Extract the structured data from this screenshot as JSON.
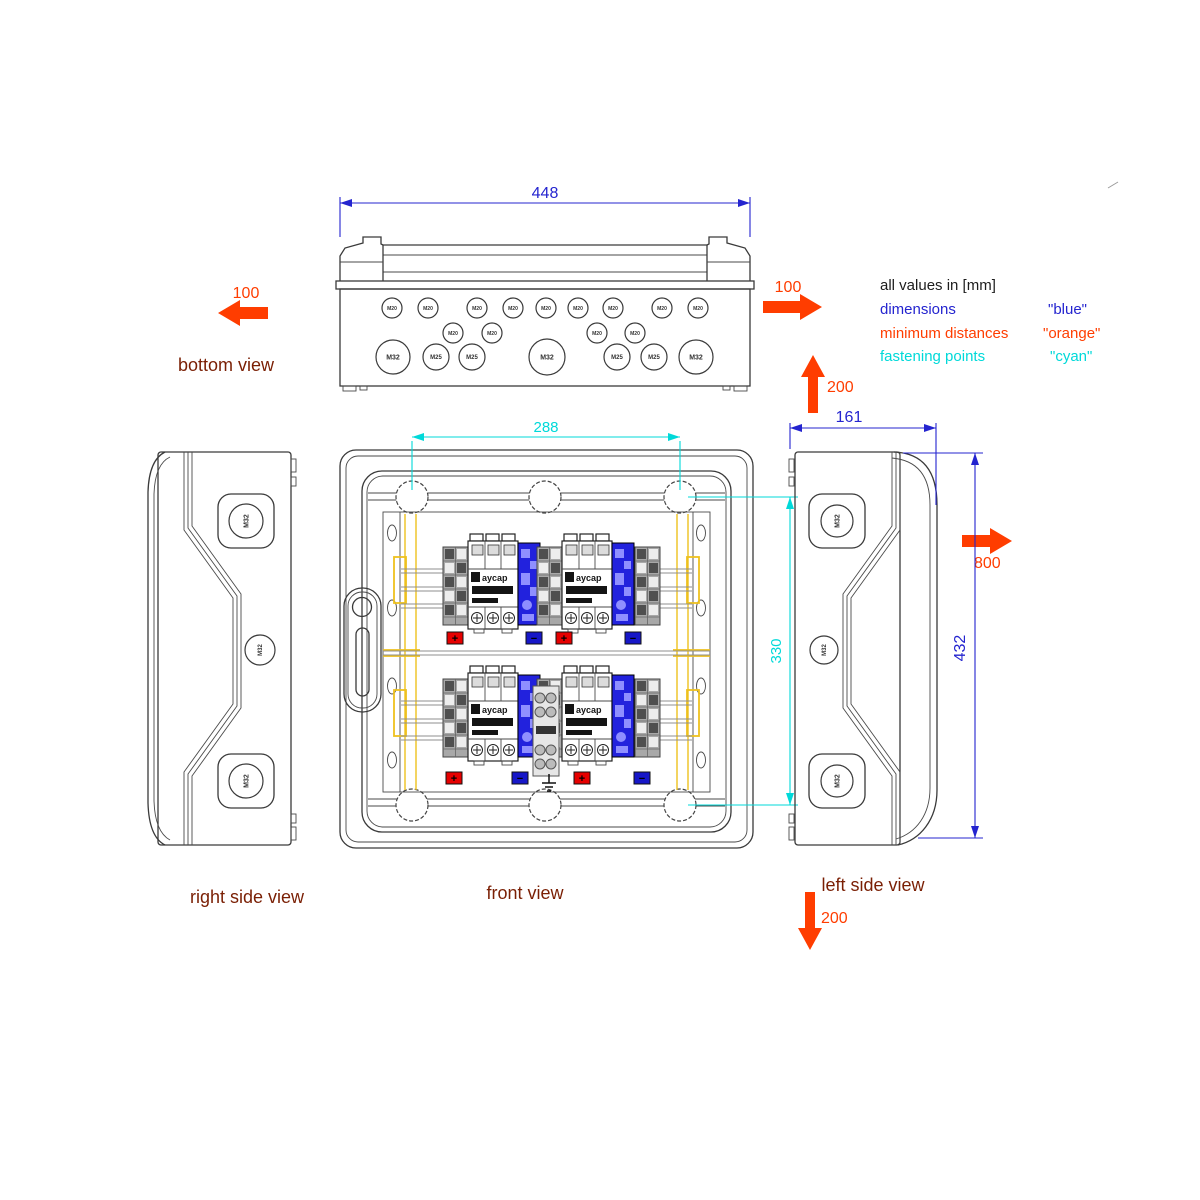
{
  "legend": {
    "title": "all values in [mm]",
    "rows": [
      {
        "label": "dimensions",
        "value": "\"blue\"",
        "color": "#2424cf"
      },
      {
        "label": "minimum distances",
        "value": "\"orange\"",
        "color": "#ff3d00"
      },
      {
        "label": "fastening points",
        "value": "\"cyan\"",
        "color": "#00d9d9"
      }
    ]
  },
  "view_labels": {
    "bottom": "bottom view",
    "front": "front view",
    "right_side": "right side view",
    "left_side": "left side view"
  },
  "dimensions": {
    "overall_width": "448",
    "fastening_width": "288",
    "fastening_height": "330",
    "depth": "161",
    "overall_height": "432"
  },
  "min_distances": {
    "left": "100",
    "right": "100",
    "above": "200",
    "below": "200",
    "side": "800"
  },
  "colors": {
    "dimension_blue": "#2424cf",
    "minimum_distance_orange": "#ff3d00",
    "fastening_cyan": "#00d9d9",
    "view_label_maroon": "#7a1f04",
    "device_blue": "#2222dd",
    "marker_red": "#e60000",
    "marker_blue": "#1717c8",
    "panel_yellow": "#eec11e"
  },
  "bottom_view_glands": {
    "row1": [
      "M20",
      "M20",
      "M20",
      "M20",
      "M20",
      "M20",
      "M20",
      "M20",
      "M20"
    ],
    "row2": [
      "M20",
      "M20",
      "M20",
      "M20"
    ],
    "row3": [
      "M32",
      "M25",
      "M25",
      "M32",
      "M25",
      "M25",
      "M32"
    ]
  },
  "right_side_glands": [
    "M32",
    "M32",
    "M32"
  ],
  "left_side_glands": [
    "M32",
    "M32",
    "M32"
  ],
  "device_label": "aycap",
  "terminal_markers": {
    "row1": [
      "+",
      "−",
      "+",
      "−"
    ],
    "row2": [
      "+",
      "−",
      "+",
      "−"
    ]
  }
}
